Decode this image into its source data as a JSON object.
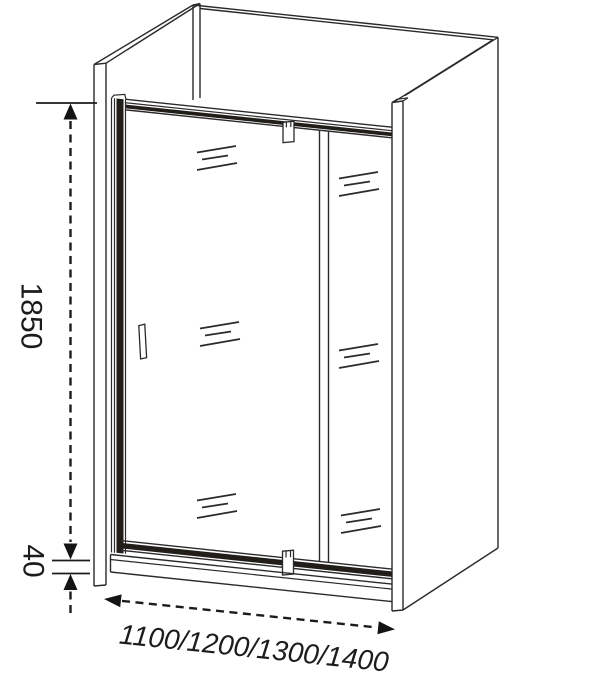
{
  "diagram": {
    "background_color": "#ffffff",
    "line_color": "#2a2a2a",
    "dimensions": {
      "height_label": "1850",
      "base_height_label": "40",
      "width_options_label": "1100/1200/1300/1400"
    }
  }
}
